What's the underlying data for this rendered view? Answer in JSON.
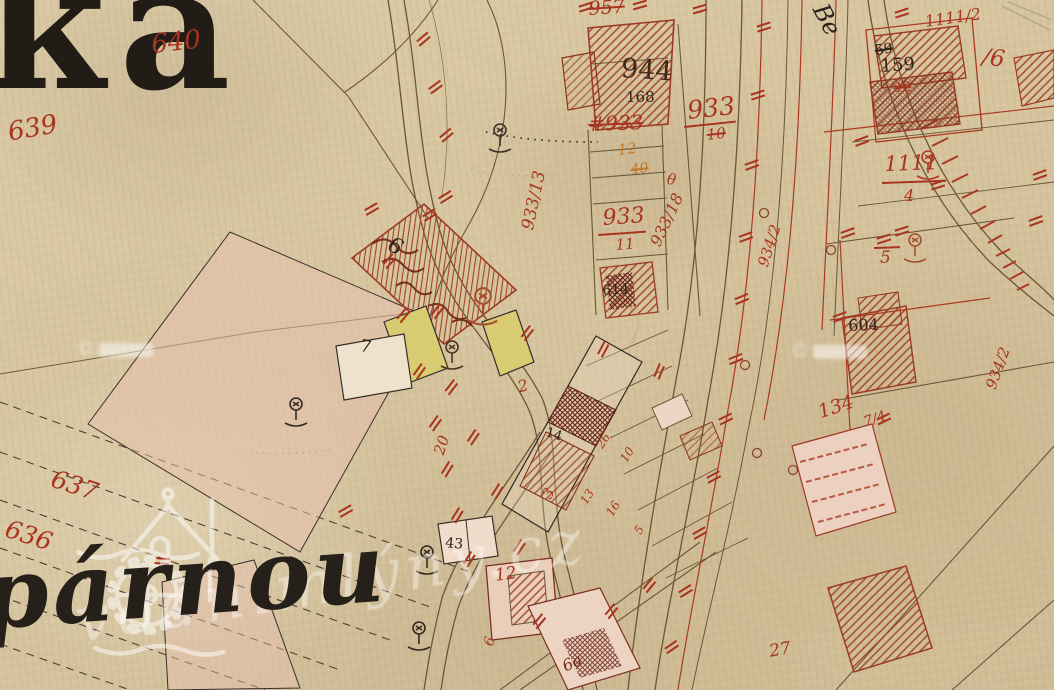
{
  "map": {
    "ink_colors": {
      "red_ink": "#a8341f",
      "dark_red_ink": "#7c2a1a",
      "black_ink": "#2b241d",
      "orange_ink": "#bf7b2c",
      "line_brown": "#6b5738",
      "paper": "#d7c5a0",
      "yellow_building": "#d9cb72",
      "pink_parcel": "#e7bfae"
    },
    "place_labels": {
      "top_left_fragment": "ka",
      "bottom_left_fragment": "párnou",
      "top_right_fragment": "Be"
    },
    "watermark": {
      "site_text": "vodnímlýny.cz",
      "copyright_symbol": "©",
      "logo_icon": "water-mill-house-and-wheel"
    },
    "labels": [
      {
        "text": "ka"
      },
      {
        "text": "párnou"
      },
      {
        "text": "Be"
      },
      {
        "text": "640"
      },
      {
        "text": "639"
      },
      {
        "text": "637"
      },
      {
        "text": "636"
      },
      {
        "text": "957"
      },
      {
        "text": "944"
      },
      {
        "text": "168"
      },
      {
        "text": "933"
      },
      {
        "text": "10"
      },
      {
        "text": "#933"
      },
      {
        "text": "12"
      },
      {
        "text": "40"
      },
      {
        "text": "933/13"
      },
      {
        "text": "933"
      },
      {
        "text": "11"
      },
      {
        "text": "933/18"
      },
      {
        "text": "614"
      },
      {
        "text": "6"
      },
      {
        "text": "7"
      },
      {
        "text": "2"
      },
      {
        "text": "14"
      },
      {
        "text": "20"
      },
      {
        "text": "3"
      },
      {
        "text": "43"
      },
      {
        "text": "12"
      },
      {
        "text": "6"
      },
      {
        "text": "6a"
      },
      {
        "text": "13"
      },
      {
        "text": "16"
      },
      {
        "text": "5"
      },
      {
        "text": "26"
      },
      {
        "text": "10"
      },
      {
        "text": "134"
      },
      {
        "text": "7/4"
      },
      {
        "text": "27"
      },
      {
        "text": "934/2"
      },
      {
        "text": "934/2"
      },
      {
        "text": "1111/2"
      },
      {
        "text": "59"
      },
      {
        "text": "159"
      },
      {
        "text": "12"
      },
      {
        "text": "/6"
      },
      {
        "text": "1111"
      },
      {
        "text": "4"
      },
      {
        "text": "5"
      },
      {
        "text": "604"
      },
      {
        "text": "θ"
      }
    ]
  }
}
